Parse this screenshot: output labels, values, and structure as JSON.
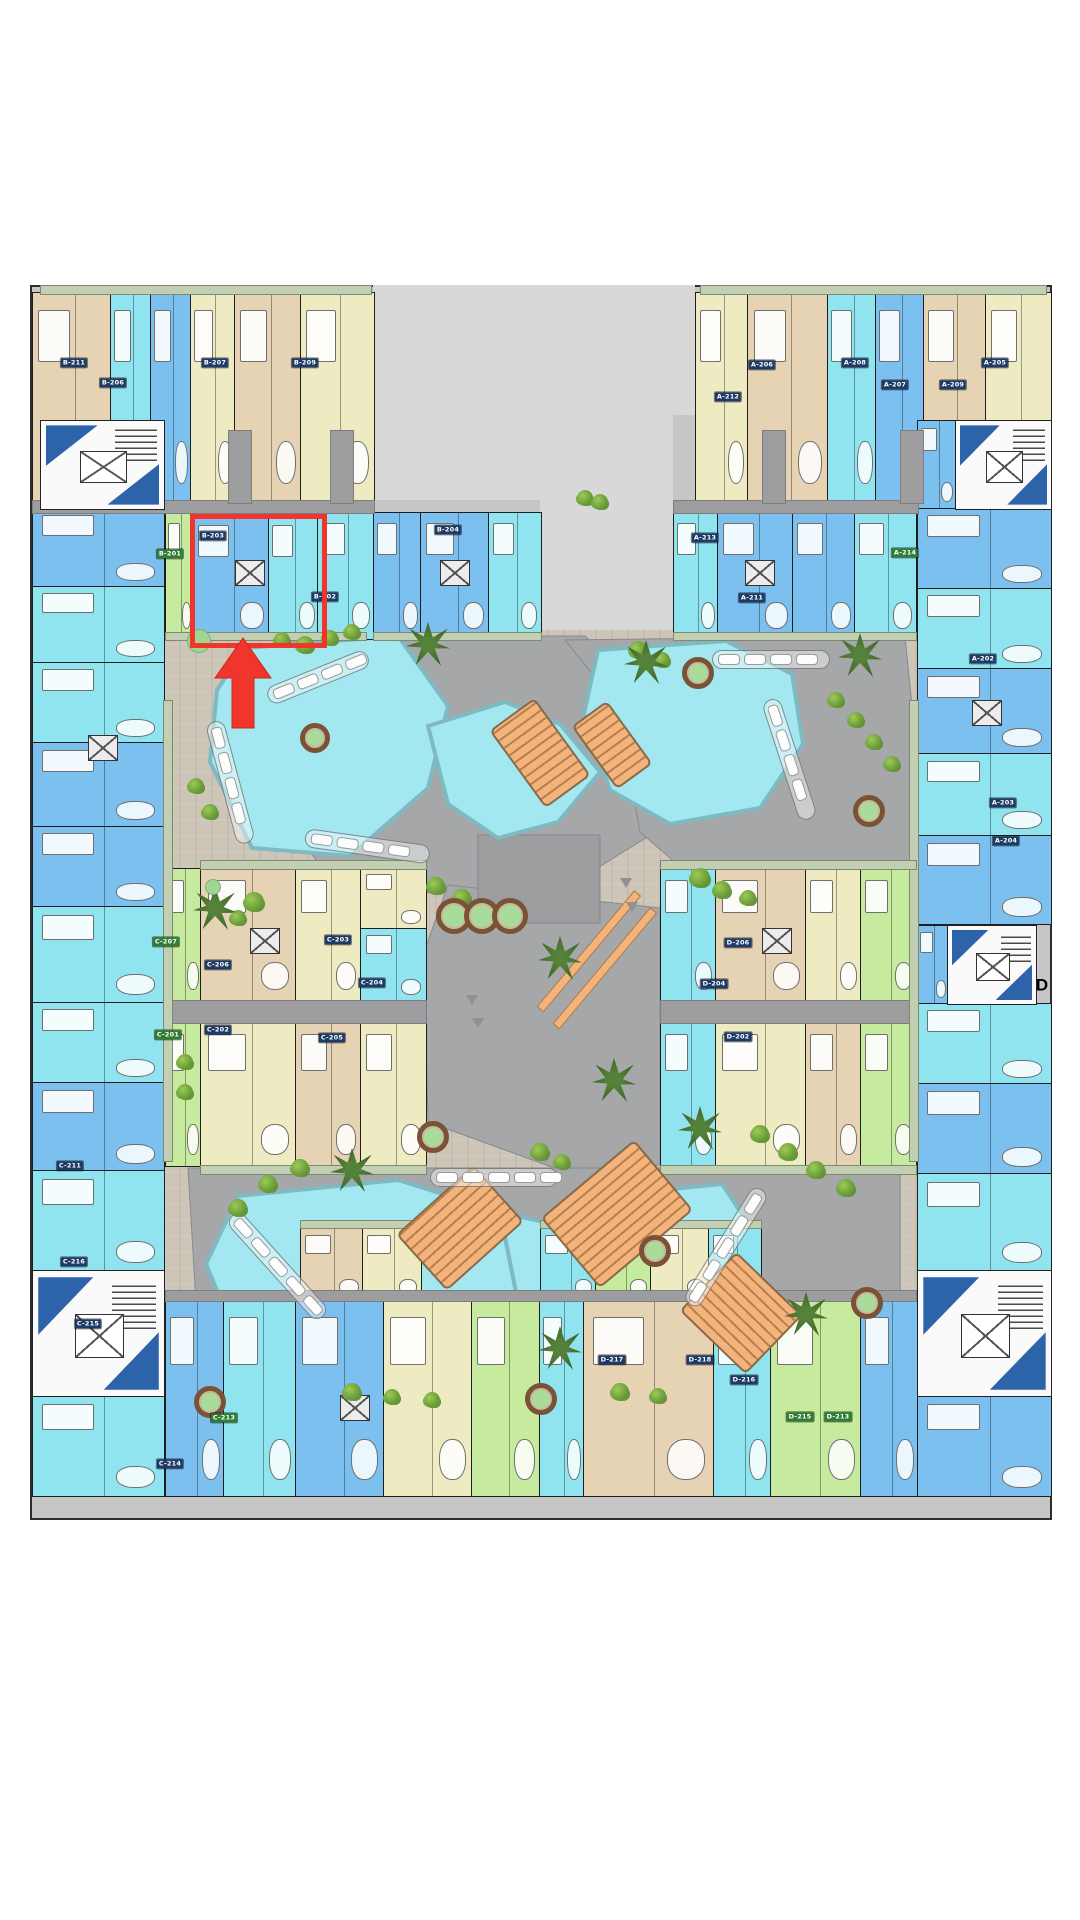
{
  "canvas": {
    "w": 1080,
    "h": 1920,
    "bg": "#ffffff"
  },
  "palette": {
    "base_gray": "#c6c6c6",
    "notch_gray": "#d8d8d8",
    "courtyard_beige": "#cdc6b8",
    "stone_gray": "#a5a7a9",
    "stone_dark": "#9c9ea0",
    "corridor_gray": "#9d9da0",
    "pool_fill": "#a3e8f0",
    "pool_edge": "#7fb9c1",
    "deck_orange": "#f3b37b",
    "unit_tan": "#e6d3b3",
    "unit_cream": "#eeeac2",
    "unit_cyan": "#8fe4ef",
    "unit_blue": "#7cc0ef",
    "unit_green": "#c6ea9e",
    "stair_navy": "#2d63a8",
    "balcony_green": "#c2cfb2",
    "highlight_red": "#f0352c",
    "badge_navy": "#1d3b66",
    "badge_green": "#2e7d32",
    "tree_green": "#6a9c38"
  },
  "site": {
    "base": {
      "x": 30,
      "y": 285,
      "w": 1022,
      "h": 1235
    },
    "notches": [
      [
        373,
        285,
        167,
        215
      ],
      [
        540,
        285,
        155,
        130
      ],
      [
        540,
        415,
        133,
        215
      ]
    ],
    "courtyard": {
      "x": 163,
      "y": 630,
      "w": 754,
      "h": 767
    }
  },
  "stone_polys": [
    "285,636 585,636 648,700 662,828 565,888 420,893 325,872 272,800 262,700",
    "565,640 905,636 912,706 912,862 828,884 700,884 640,832 618,706",
    "448,885 660,908 660,1165 560,1170 428,1122 424,952",
    "188,1168 900,1168 900,1292 782,1382 322,1382 196,1302"
  ],
  "stone_dark_polys": [
    "478,835 600,835 600,923 478,923"
  ],
  "pools": [
    "245,648 398,636 448,706 428,788 350,856 252,848 210,762 217,690",
    "428,726 505,702 560,724 600,772 558,822 498,838 448,804",
    "598,650 726,641 792,674 803,744 760,808 670,824 610,790 584,714",
    "238,1196 398,1180 500,1212 516,1292 468,1372 338,1390 240,1346 206,1264",
    "500,1212 588,1232 588,1330 520,1390 452,1368 516,1292",
    "588,1232 642,1192 722,1184 754,1232 748,1302 700,1347 620,1344 588,1300"
  ],
  "units": [
    [
      32,
      292,
      78,
      208,
      "tan"
    ],
    [
      110,
      292,
      40,
      208,
      "cyan"
    ],
    [
      150,
      292,
      40,
      208,
      "blue"
    ],
    [
      190,
      292,
      44,
      208,
      "cream"
    ],
    [
      234,
      292,
      66,
      208,
      "tan"
    ],
    [
      300,
      292,
      73,
      208,
      "cream"
    ],
    [
      695,
      292,
      52,
      208,
      "cream"
    ],
    [
      747,
      292,
      80,
      208,
      "tan"
    ],
    [
      827,
      292,
      48,
      208,
      "cyan"
    ],
    [
      875,
      292,
      48,
      208,
      "blue"
    ],
    [
      923,
      292,
      62,
      208,
      "tan"
    ],
    [
      985,
      292,
      65,
      208,
      "cream"
    ],
    [
      917,
      420,
      38,
      88,
      "blue"
    ],
    [
      165,
      512,
      27,
      126,
      "green"
    ],
    [
      192,
      514,
      76,
      124,
      "blue"
    ],
    [
      268,
      514,
      49,
      124,
      "cyan"
    ],
    [
      317,
      512,
      56,
      126,
      "cyan"
    ],
    [
      373,
      512,
      47,
      126,
      "blue"
    ],
    [
      420,
      512,
      68,
      126,
      "blue"
    ],
    [
      488,
      512,
      52,
      126,
      "cyan"
    ],
    [
      673,
      512,
      44,
      126,
      "cyan"
    ],
    [
      717,
      512,
      75,
      126,
      "blue"
    ],
    [
      792,
      512,
      62,
      126,
      "blue"
    ],
    [
      854,
      512,
      61,
      126,
      "cyan"
    ],
    [
      32,
      508,
      131,
      78,
      "blue"
    ],
    [
      32,
      586,
      131,
      76,
      "cyan"
    ],
    [
      32,
      662,
      131,
      80,
      "cyan"
    ],
    [
      32,
      742,
      131,
      84,
      "blue"
    ],
    [
      32,
      826,
      131,
      80,
      "blue"
    ],
    [
      32,
      906,
      131,
      96,
      "cyan"
    ],
    [
      32,
      1002,
      131,
      80,
      "cyan"
    ],
    [
      32,
      1082,
      131,
      88,
      "blue"
    ],
    [
      32,
      1170,
      131,
      100,
      "cyan"
    ],
    [
      917,
      508,
      133,
      80,
      "blue"
    ],
    [
      917,
      588,
      133,
      80,
      "cyan"
    ],
    [
      917,
      668,
      133,
      85,
      "blue"
    ],
    [
      917,
      753,
      133,
      82,
      "cyan"
    ],
    [
      917,
      835,
      133,
      88,
      "blue"
    ],
    [
      917,
      925,
      30,
      78,
      "blue"
    ],
    [
      917,
      1003,
      133,
      80,
      "cyan"
    ],
    [
      917,
      1083,
      133,
      90,
      "blue"
    ],
    [
      917,
      1173,
      133,
      97,
      "cyan"
    ],
    [
      165,
      868,
      35,
      132,
      "green"
    ],
    [
      200,
      868,
      95,
      132,
      "tan"
    ],
    [
      295,
      868,
      65,
      132,
      "cream"
    ],
    [
      360,
      868,
      65,
      60,
      "cream"
    ],
    [
      360,
      928,
      65,
      72,
      "cyan"
    ],
    [
      165,
      1022,
      35,
      143,
      "green"
    ],
    [
      200,
      1022,
      95,
      143,
      "cream"
    ],
    [
      295,
      1022,
      65,
      143,
      "tan"
    ],
    [
      360,
      1022,
      65,
      143,
      "cream"
    ],
    [
      660,
      868,
      55,
      132,
      "cyan"
    ],
    [
      715,
      868,
      90,
      132,
      "tan"
    ],
    [
      805,
      868,
      55,
      132,
      "cream"
    ],
    [
      860,
      868,
      55,
      132,
      "green"
    ],
    [
      660,
      1022,
      55,
      143,
      "cyan"
    ],
    [
      715,
      1022,
      90,
      143,
      "cream"
    ],
    [
      805,
      1022,
      55,
      143,
      "tan"
    ],
    [
      860,
      1022,
      55,
      143,
      "green"
    ],
    [
      300,
      1228,
      62,
      72,
      "tan"
    ],
    [
      362,
      1228,
      58,
      72,
      "cream"
    ],
    [
      540,
      1228,
      55,
      72,
      "cyan"
    ],
    [
      595,
      1228,
      55,
      72,
      "green"
    ],
    [
      650,
      1228,
      58,
      72,
      "cream"
    ],
    [
      708,
      1228,
      52,
      72,
      "cyan"
    ],
    [
      165,
      1300,
      58,
      195,
      "blue"
    ],
    [
      223,
      1300,
      72,
      195,
      "cyan"
    ],
    [
      295,
      1300,
      88,
      195,
      "blue"
    ],
    [
      383,
      1300,
      88,
      195,
      "cream"
    ],
    [
      471,
      1300,
      68,
      195,
      "green"
    ],
    [
      539,
      1300,
      44,
      195,
      "cyan"
    ],
    [
      583,
      1300,
      130,
      195,
      "tan"
    ],
    [
      713,
      1300,
      57,
      195,
      "cyan"
    ],
    [
      770,
      1300,
      90,
      195,
      "green"
    ],
    [
      860,
      1300,
      57,
      195,
      "blue"
    ],
    [
      32,
      1395,
      131,
      100,
      "cyan"
    ],
    [
      917,
      1395,
      133,
      100,
      "blue"
    ]
  ],
  "stairs": [
    [
      40,
      420,
      123,
      88
    ],
    [
      955,
      420,
      95,
      88
    ],
    [
      32,
      1270,
      131,
      125
    ],
    [
      917,
      1270,
      133,
      125
    ],
    [
      947,
      925,
      88,
      78
    ]
  ],
  "corridors": [
    [
      32,
      500,
      341,
      12
    ],
    [
      673,
      500,
      244,
      12
    ],
    [
      165,
      1000,
      260,
      22
    ],
    [
      660,
      1000,
      255,
      22
    ],
    [
      165,
      1290,
      750,
      10
    ],
    [
      92,
      430,
      22,
      72
    ],
    [
      228,
      430,
      22,
      72
    ],
    [
      330,
      430,
      22,
      72
    ],
    [
      762,
      430,
      22,
      72
    ],
    [
      900,
      430,
      22,
      72
    ]
  ],
  "strips": [
    [
      40,
      285,
      330,
      8
    ],
    [
      700,
      285,
      345,
      8
    ],
    [
      165,
      632,
      200,
      7
    ],
    [
      373,
      632,
      167,
      7
    ],
    [
      673,
      632,
      242,
      7
    ],
    [
      163,
      700,
      8,
      460
    ],
    [
      909,
      700,
      8,
      460
    ],
    [
      200,
      860,
      225,
      8
    ],
    [
      660,
      860,
      255,
      8
    ],
    [
      200,
      1165,
      225,
      8
    ],
    [
      660,
      1165,
      255,
      8
    ],
    [
      300,
      1220,
      120,
      7
    ],
    [
      540,
      1220,
      220,
      7
    ]
  ],
  "xboxes": [
    [
      235,
      560
    ],
    [
      440,
      560
    ],
    [
      745,
      560
    ],
    [
      88,
      735
    ],
    [
      972,
      700
    ],
    [
      250,
      928
    ],
    [
      762,
      928
    ],
    [
      340,
      1395
    ]
  ],
  "tracks": [
    [
      268,
      688,
      100,
      -22,
      4
    ],
    [
      214,
      712,
      118,
      75,
      4
    ],
    [
      305,
      828,
      118,
      8,
      4
    ],
    [
      712,
      650,
      110,
      0,
      4
    ],
    [
      770,
      690,
      118,
      72,
      4
    ],
    [
      232,
      1206,
      128,
      48,
      5
    ],
    [
      430,
      1168,
      120,
      0,
      5
    ],
    [
      762,
      1180,
      128,
      122,
      5
    ]
  ],
  "decks": [
    [
      512,
      705,
      52,
      92,
      -36
    ],
    [
      590,
      706,
      40,
      74,
      -36
    ],
    [
      408,
      1190,
      100,
      72,
      -42
    ],
    [
      556,
      1168,
      118,
      88,
      -40
    ],
    [
      695,
      1272,
      88,
      78,
      44
    ]
  ],
  "ramp_bars": [
    [
      540,
      1005,
      150,
      7,
      -50
    ],
    [
      556,
      1022,
      150,
      7,
      -50
    ]
  ],
  "chevrons": [
    [
      466,
      995
    ],
    [
      472,
      1018
    ],
    [
      620,
      878
    ],
    [
      626,
      902
    ]
  ],
  "bushes": [
    [
      305,
      645,
      9
    ],
    [
      330,
      638,
      8
    ],
    [
      352,
      632,
      8
    ],
    [
      282,
      640,
      8
    ],
    [
      436,
      886,
      9
    ],
    [
      462,
      898,
      9
    ],
    [
      210,
      812,
      8
    ],
    [
      196,
      786,
      8
    ],
    [
      700,
      878,
      10
    ],
    [
      722,
      890,
      9
    ],
    [
      748,
      898,
      8
    ],
    [
      836,
      700,
      8
    ],
    [
      856,
      720,
      8
    ],
    [
      874,
      742,
      8
    ],
    [
      892,
      764,
      8
    ],
    [
      638,
      650,
      9
    ],
    [
      662,
      660,
      8
    ],
    [
      254,
      902,
      10
    ],
    [
      238,
      918,
      8
    ],
    [
      185,
      1062,
      8
    ],
    [
      185,
      1092,
      8
    ],
    [
      540,
      1152,
      9
    ],
    [
      562,
      1162,
      8
    ],
    [
      430,
      1136,
      9
    ],
    [
      300,
      1168,
      9
    ],
    [
      268,
      1184,
      9
    ],
    [
      238,
      1208,
      9
    ],
    [
      760,
      1134,
      9
    ],
    [
      788,
      1152,
      9
    ],
    [
      816,
      1170,
      9
    ],
    [
      846,
      1188,
      9
    ],
    [
      352,
      1392,
      9
    ],
    [
      392,
      1397,
      8
    ],
    [
      432,
      1400,
      8
    ],
    [
      620,
      1392,
      9
    ],
    [
      658,
      1396,
      8
    ],
    [
      585,
      498,
      8
    ],
    [
      600,
      502,
      8
    ]
  ],
  "palms": [
    [
      428,
      644
    ],
    [
      646,
      662
    ],
    [
      860,
      655
    ],
    [
      560,
      958
    ],
    [
      614,
      1080
    ],
    [
      700,
      1128
    ],
    [
      352,
      1170
    ],
    [
      560,
      1348
    ],
    [
      806,
      1314
    ],
    [
      215,
      908
    ]
  ],
  "planters": [
    [
      449,
      911,
      13
    ],
    [
      477,
      911,
      13
    ],
    [
      505,
      911,
      13
    ],
    [
      693,
      668,
      11
    ],
    [
      310,
      733,
      10
    ],
    [
      864,
      806,
      11
    ],
    [
      428,
      1132,
      11
    ],
    [
      650,
      1246,
      11
    ],
    [
      862,
      1298,
      11
    ],
    [
      536,
      1394,
      11
    ],
    [
      205,
      1397,
      11
    ]
  ],
  "greenpads": [
    [
      198,
      640,
      11
    ],
    [
      212,
      886,
      7
    ]
  ],
  "badges": [
    [
      "B-211",
      74,
      363,
      "n"
    ],
    [
      "B-207",
      215,
      363,
      "n"
    ],
    [
      "B-209",
      305,
      363,
      "n"
    ],
    [
      "B-206",
      113,
      383,
      "n"
    ],
    [
      "B-203",
      213,
      536,
      "n"
    ],
    [
      "B-201",
      170,
      554,
      "g"
    ],
    [
      "B-202",
      325,
      597,
      "n"
    ],
    [
      "B-204",
      448,
      530,
      "n"
    ],
    [
      "A-212",
      728,
      397,
      "n"
    ],
    [
      "A-206",
      762,
      365,
      "n"
    ],
    [
      "A-208",
      855,
      363,
      "n"
    ],
    [
      "A-205",
      995,
      363,
      "n"
    ],
    [
      "A-207",
      895,
      385,
      "n"
    ],
    [
      "A-209",
      953,
      385,
      "n"
    ],
    [
      "A-213",
      705,
      538,
      "n"
    ],
    [
      "A-211",
      752,
      598,
      "n"
    ],
    [
      "A-214",
      905,
      553,
      "g"
    ],
    [
      "A-202",
      983,
      659,
      "n"
    ],
    [
      "A-203",
      1003,
      803,
      "n"
    ],
    [
      "A-204",
      1006,
      841,
      "n"
    ],
    [
      "C-207",
      166,
      942,
      "g"
    ],
    [
      "C-206",
      218,
      965,
      "n"
    ],
    [
      "C-203",
      338,
      940,
      "n"
    ],
    [
      "C-204",
      372,
      983,
      "n"
    ],
    [
      "C-201",
      168,
      1035,
      "g"
    ],
    [
      "C-202",
      218,
      1030,
      "n"
    ],
    [
      "C-205",
      332,
      1038,
      "n"
    ],
    [
      "C-211",
      70,
      1166,
      "n"
    ],
    [
      "C-216",
      74,
      1262,
      "n"
    ],
    [
      "C-215",
      88,
      1324,
      "n"
    ],
    [
      "C-213",
      224,
      1418,
      "g"
    ],
    [
      "C-214",
      170,
      1464,
      "n"
    ],
    [
      "D-206",
      738,
      943,
      "n"
    ],
    [
      "D-204",
      714,
      984,
      "n"
    ],
    [
      "D-202",
      738,
      1037,
      "n"
    ],
    [
      "D-217",
      612,
      1360,
      "n"
    ],
    [
      "D-218",
      700,
      1360,
      "n"
    ],
    [
      "D-216",
      744,
      1380,
      "n"
    ],
    [
      "D-215",
      800,
      1417,
      "g"
    ],
    [
      "D-213",
      838,
      1417,
      "g"
    ]
  ],
  "marker": {
    "box": {
      "x": 190,
      "y": 514,
      "w": 127,
      "h": 124
    },
    "arrow_points": "243,638 271,678 254,678 254,728 232,728 232,678 215,678",
    "color": "#f0352c"
  },
  "labels": {
    "block_d": {
      "text": "D",
      "x": 1042,
      "y": 985
    }
  }
}
